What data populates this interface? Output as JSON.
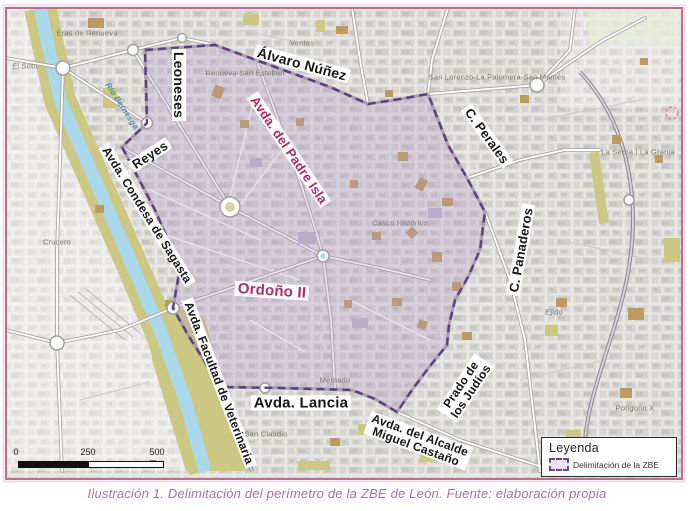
{
  "figure": {
    "caption": "Ilustración 1. Delimitación del perímetro de la ZBE de León. Fuente: elaboración propia"
  },
  "legend": {
    "title": "Leyenda",
    "items": [
      {
        "label": "Delimitación de la ZBE",
        "swatch": "dashed-purple-rect"
      }
    ]
  },
  "scale_bar": {
    "ticks": [
      {
        "label": "0",
        "x": 16,
        "y": 447
      },
      {
        "label": "250",
        "x": 88,
        "y": 447
      },
      {
        "label": "500 m",
        "x": 157,
        "y": 447
      }
    ]
  },
  "colors": {
    "accent_magenta": "#ad2a68",
    "boundary_purple": "#5e3f7d",
    "zbe_fill_lavender": "#cabadd",
    "caption_mauve": "#a472a8",
    "frame_pink": "#bb6f8e",
    "river_blue": "#a8d8ea",
    "park_olive": "#ccc883",
    "landmark_tan": "#bf9a5e"
  },
  "map": {
    "boundary_name": "Delimitación de la ZBE",
    "street_labels": [
      {
        "id": "alvaro-nunez",
        "text": "Álvaro Núñez",
        "x": 302,
        "y": 64,
        "rot": 15,
        "size": 14
      },
      {
        "id": "leoneses",
        "text": "Leoneses",
        "x": 179,
        "y": 85,
        "rot": 90,
        "size": 14
      },
      {
        "id": "reyes",
        "text": "Reyes",
        "x": 150,
        "y": 155,
        "rot": -33,
        "size": 13
      },
      {
        "id": "avda-del-padre-isla",
        "text": "Avda. del Padre Isla",
        "x": 289,
        "y": 150,
        "rot": 56,
        "size": 13,
        "variant": "magenta"
      },
      {
        "id": "avda-condesa-sagasta",
        "text": "Avda. Condesa de Sagasta",
        "x": 147,
        "y": 215,
        "rot": 58,
        "size": 12
      },
      {
        "id": "avda-facultad-veterinaria",
        "text": "Avda. Facultad de Veterinaria",
        "x": 219,
        "y": 383,
        "rot": 69,
        "size": 12
      },
      {
        "id": "ordono-ii",
        "text": "Ordoño II",
        "x": 272,
        "y": 291,
        "rot": 4,
        "size": 15,
        "variant": "magenta"
      },
      {
        "id": "avda-lancia",
        "text": "Avda. Lancia",
        "x": 301,
        "y": 403,
        "rot": 0,
        "size": 15
      },
      {
        "id": "avda-alcalde-miguel-castano",
        "text": "Avda. del Alcalde\nMiguel Castaño",
        "x": 418,
        "y": 441,
        "rot": 20,
        "size": 12
      },
      {
        "id": "c-perales",
        "text": "C. Perales",
        "x": 487,
        "y": 136,
        "rot": 54,
        "size": 13
      },
      {
        "id": "c-panaderos",
        "text": "C. Panaderos",
        "x": 521,
        "y": 250,
        "rot": -80,
        "size": 13
      },
      {
        "id": "prado-de-los-judios",
        "text": "Prado de\nlos Judíos",
        "x": 466,
        "y": 388,
        "rot": -56,
        "size": 12
      }
    ],
    "area_labels": [
      {
        "id": "eras-de-renueva",
        "text": "Eras de Renueva",
        "x": 87,
        "y": 33
      },
      {
        "id": "ventas",
        "text": "Ventas",
        "x": 302,
        "y": 43
      },
      {
        "id": "el-soto",
        "text": "El Soto",
        "x": 25,
        "y": 66
      },
      {
        "id": "renueva-san-esteban",
        "text": "Renueva-San Esteban",
        "x": 245,
        "y": 73
      },
      {
        "id": "san-lorenzo-la-palomera-san-mames",
        "text": "San Lorenzo-La Palomera-San Mamés",
        "x": 497,
        "y": 77
      },
      {
        "id": "la-serna-la-granja",
        "text": "La Serna | La Granja",
        "x": 638,
        "y": 152
      },
      {
        "id": "casco-historico",
        "text": "Casco Histórico",
        "x": 400,
        "y": 223
      },
      {
        "id": "ejido",
        "text": "Ejido",
        "x": 554,
        "y": 312
      },
      {
        "id": "mercado",
        "text": "Mercado",
        "x": 335,
        "y": 380
      },
      {
        "id": "san-claudio",
        "text": "San Claudio",
        "x": 266,
        "y": 434
      },
      {
        "id": "poligono-x",
        "text": "Polígono X",
        "x": 635,
        "y": 408
      },
      {
        "id": "crucero",
        "text": "Crucero",
        "x": 57,
        "y": 242
      },
      {
        "id": "rio-bernesga",
        "text": "Río Bernesga",
        "x": 122,
        "y": 106,
        "rot": 57,
        "variant": "river"
      }
    ]
  }
}
